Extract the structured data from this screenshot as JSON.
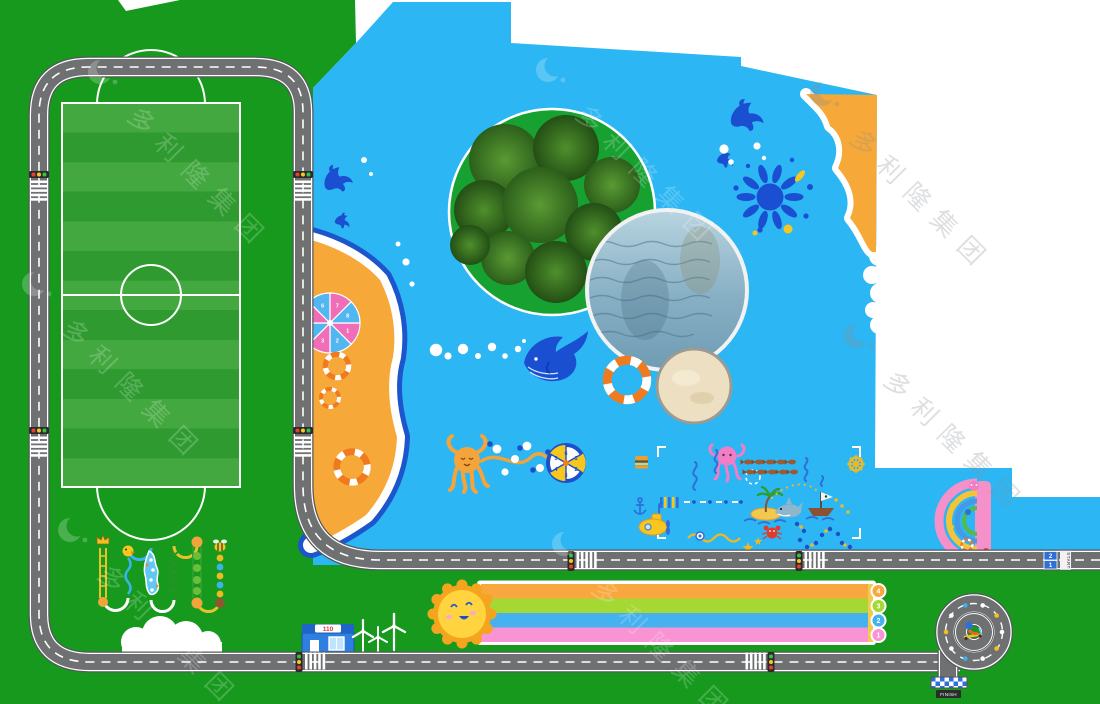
{
  "watermark": {
    "text": "多利隆集团",
    "logo": "crescent-moon-logo",
    "color": "#ffffff",
    "opacity": "0.2"
  },
  "signs": {
    "police_station_sign": "110",
    "start_label": "START",
    "start_lane_numbers": [
      "2",
      "1"
    ],
    "finish_label": "FINISH"
  },
  "running_track": {
    "lane_badge_numbers": [
      "4",
      "3",
      "2",
      "1"
    ],
    "lane_colors": [
      "#f9a83f",
      "#a6d833",
      "#45b1ef",
      "#f893d4"
    ]
  },
  "games": {
    "spinner_wheel_numbers": [
      "1",
      "2",
      "3",
      "4",
      "5",
      "6"
    ],
    "umbrella_numbers": [
      "1",
      "2",
      "3",
      "4",
      "5",
      "6",
      "7",
      "8"
    ]
  },
  "colors": {
    "grass": "#16991d",
    "field_stripe_light": "#43a83f",
    "field_stripe_dark": "#2f9a30",
    "water": "#2cb6f3",
    "sand": "#f6a838",
    "road": "#6e7072",
    "road_casing": "#54575a",
    "deep_blue": "#1a4fd2",
    "accent_yellow": "#f7c71f",
    "umbrella_pink": "#f06eb8",
    "umbrella_blue": "#52b7f0"
  },
  "icons": {
    "dolphin-icon": "leaping dolphin silhouette",
    "whale-icon": "blue whale with bubbles",
    "splash-icon": "paint splash with droplets",
    "tree-island-icon": "round island with trees",
    "pond-icon": "round water pool",
    "sand-pit-icon": "round sand pit",
    "swim-ring-icon": "striped life ring",
    "beach-umbrella-icon": "numbered parasol",
    "sun-icon": "smiling sun at track start",
    "traffic-light-icon": "3-lamp signal",
    "crosswalk-icon": "zebra stripes",
    "spiral-roundabout": "spiral road end",
    "finish-checker": "checkered finish strip",
    "police-station-icon": "blue 110 building",
    "wind-turbine-icon": "white wind turbine",
    "cloud-icon": "white cloud",
    "octopus-icon": "orange octopus game",
    "spinner-wheel-icon": "numbered prize wheel",
    "submarine-icon": "yellow submarine",
    "pirate-ship-icon": "small pirate boat",
    "palm-island-icon": "palm tree islet",
    "shark-icon": "small shark",
    "crab-icon": "red crab",
    "starfish-icon": "yellow starfish",
    "hamburger-icon": "burger marker",
    "rainbow-arch-game": "half rainbow arch with sea characters",
    "scooter-kid-icon": "kid on scooter in roundabout",
    "crown-icon": "crown start marker",
    "duck-icon": "duck badge",
    "bee-icon": "bee badge",
    "helm-icon": "ship wheel marker"
  }
}
